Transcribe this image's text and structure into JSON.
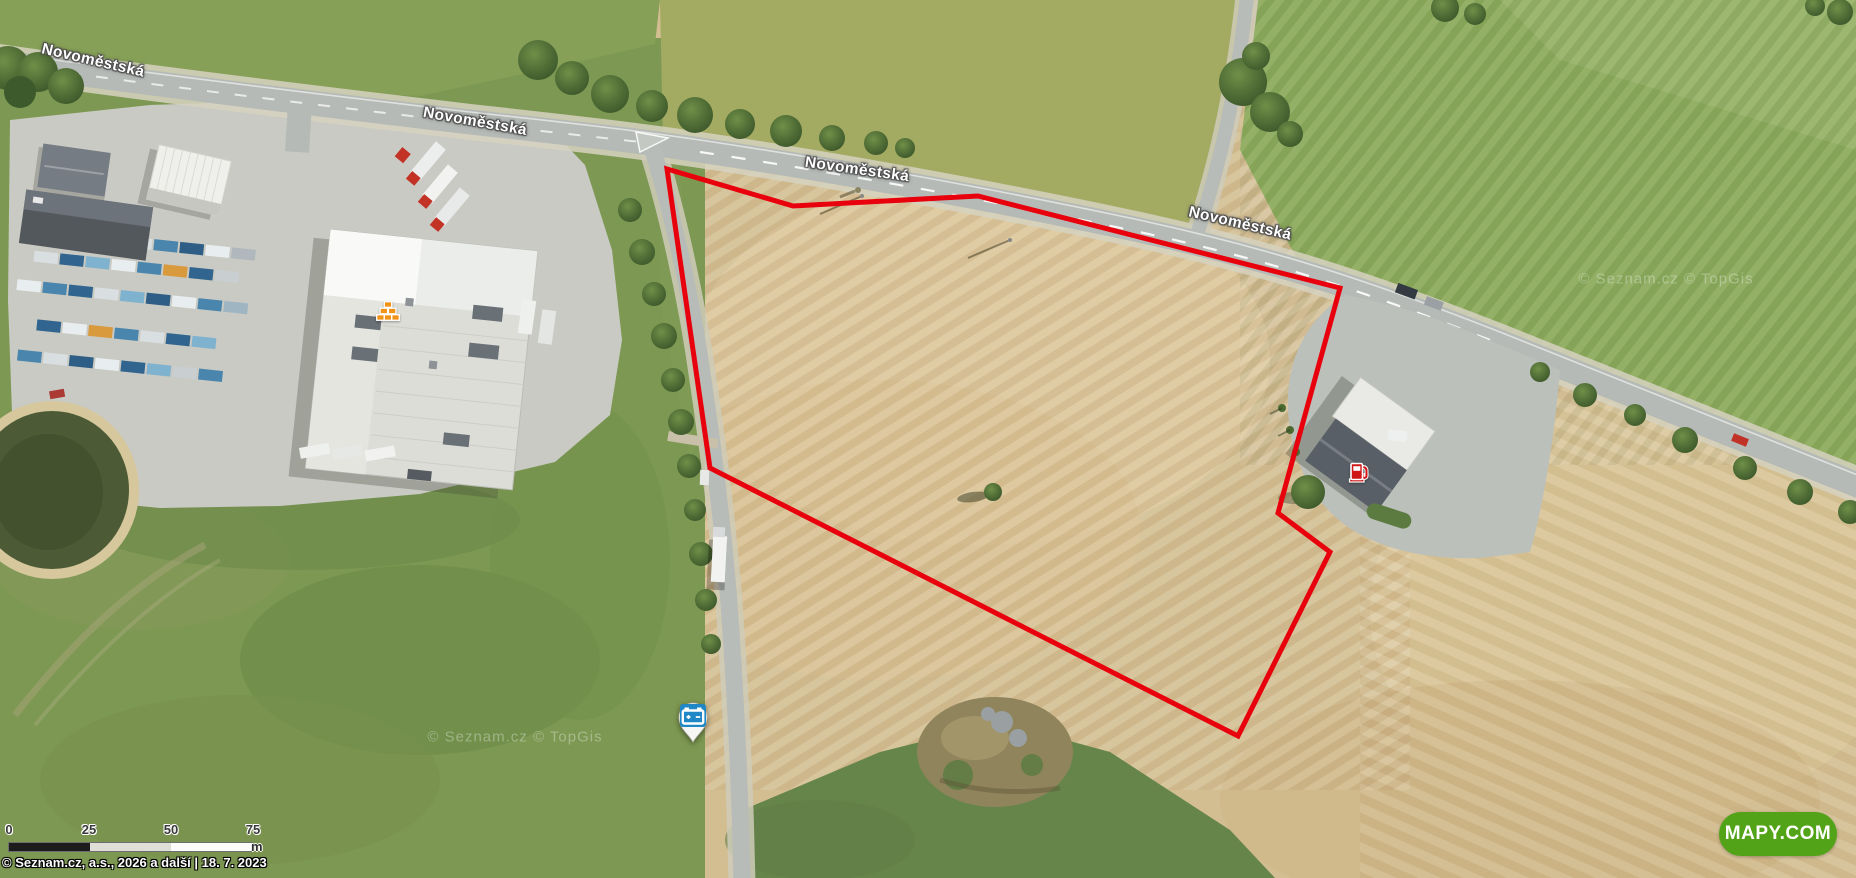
{
  "map": {
    "road_labels": [
      {
        "text": "Novoměstská"
      },
      {
        "text": "Novoměstská"
      },
      {
        "text": "Novoměstská"
      },
      {
        "text": "Novoměstská"
      }
    ],
    "watermarks": [
      {
        "text": "© Seznam.cz  © TopGis"
      },
      {
        "text": "© Seznam.cz  © TopGis"
      }
    ],
    "parcel": {
      "outline_color": "#e8000c"
    }
  },
  "markers": {
    "battery_pin": {
      "icon": "battery-icon",
      "color": "#1f87c5"
    },
    "fuel_station": {
      "icon": "fuel-pump-icon",
      "color": "#cf1515"
    },
    "building_materials": {
      "icon": "bricks-icon",
      "color": "#f09318"
    }
  },
  "scale_bar": {
    "ticks": [
      "0",
      "25",
      "50",
      "75"
    ],
    "unit": "m"
  },
  "attribution": {
    "text": "© Seznam.cz, a.s., 2026 a další | 18. 7. 2023"
  },
  "logo": {
    "text": "MAPY.COM"
  }
}
